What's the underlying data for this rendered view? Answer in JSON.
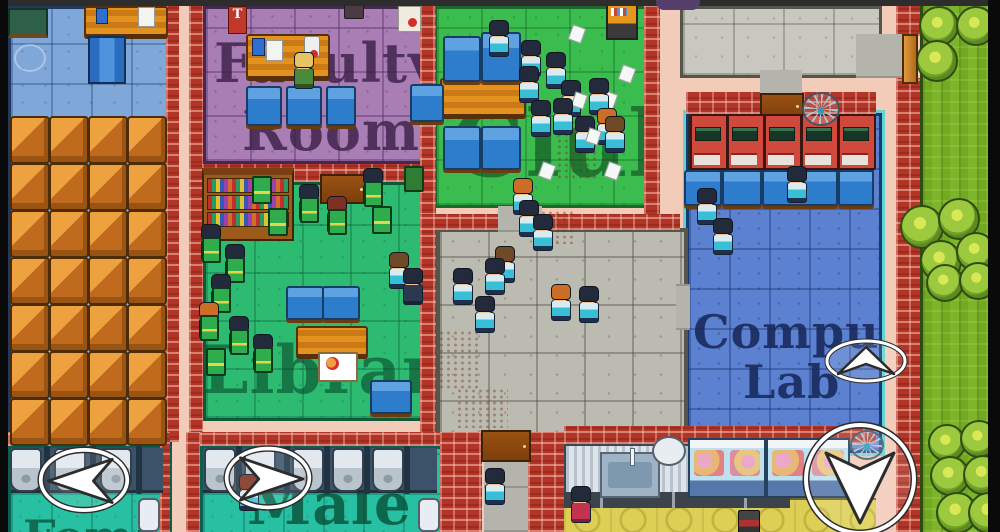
{
  "meta": {
    "width": 1000,
    "height": 532,
    "description": "Top-down pixel-art school simulation game scene"
  },
  "rooms": {
    "freshman": {
      "label": "Freshman"
    },
    "faculty": {
      "line1": "Faculty",
      "line2": "Room",
      "banner": "T"
    },
    "club": {
      "label": "Club"
    },
    "library": {
      "label": "Library"
    },
    "computer_lab": {
      "line1": "Computer",
      "line2": "Lab"
    },
    "male_toilet": {
      "label": "Male"
    },
    "female_toilet": {
      "label": "Female"
    }
  },
  "icons": {
    "nav_left": "arrow-left",
    "nav_right": "arrow-right",
    "nav_up": "arrow-up",
    "nav_down": "arrow-down",
    "web": "spider-web",
    "apple_sign": "apple"
  },
  "colors": {
    "corridor": "#f3cbb9",
    "brick": "#b23527",
    "classroom_floor": "#7fa8d9",
    "faculty_floor": "#a87eb4",
    "library_floor": "#2dbb72",
    "club_floor": "#3bbc4e",
    "lab_floor": "#5b81d0",
    "courtyard_floor": "#bcbbb2",
    "bathroom_floor": "#28c0a2",
    "kitchen_floor": "#ddcf55",
    "grass": "#74ac22",
    "hair": {
      "navy": "#222a3c",
      "orange": "#cc6d28",
      "brown": "#6e4a26",
      "blond": "#e5c564",
      "red": "#7e3122"
    },
    "outfit": {
      "student": "linear-gradient(#d7ebf3 0 35%,#38bfd6 35% 80%,#1d3050 80% 100%)",
      "teacher": "linear-gradient(#4a8a38 0 80%,#2c5420 80% 100%)",
      "suit": "linear-gradient(#2c3850 0 85%,#1a2335 85% 100%)",
      "cook": "linear-gradient(#c23350 0 85%,#7e1f33 85% 100%)"
    }
  },
  "scene": {
    "classroom_desks": {
      "cols": [
        10,
        49,
        88,
        127
      ],
      "rows": [
        116,
        163,
        210,
        257,
        304,
        351,
        398
      ]
    },
    "blue_desks": [
      {
        "x": 443,
        "y": 36,
        "w": 34,
        "h": 42
      },
      {
        "x": 481,
        "y": 32,
        "w": 36,
        "h": 46
      },
      {
        "x": 443,
        "y": 126,
        "w": 34,
        "h": 40
      },
      {
        "x": 481,
        "y": 126,
        "w": 36,
        "h": 40
      },
      {
        "x": 246,
        "y": 86,
        "w": 32,
        "h": 36
      },
      {
        "x": 286,
        "y": 86,
        "w": 32,
        "h": 36
      },
      {
        "x": 326,
        "y": 86,
        "w": 26,
        "h": 36
      },
      {
        "x": 410,
        "y": 84,
        "w": 30,
        "h": 34
      },
      {
        "x": 286,
        "y": 286,
        "w": 34,
        "h": 30
      },
      {
        "x": 322,
        "y": 286,
        "w": 34,
        "h": 30
      },
      {
        "x": 370,
        "y": 380,
        "w": 38,
        "h": 30
      },
      {
        "x": 684,
        "y": 170,
        "w": 34,
        "h": 32
      },
      {
        "x": 722,
        "y": 170,
        "w": 36,
        "h": 32
      },
      {
        "x": 762,
        "y": 170,
        "w": 72,
        "h": 32
      },
      {
        "x": 838,
        "y": 170,
        "w": 32,
        "h": 32
      }
    ],
    "computers": {
      "xs": [
        690,
        727,
        764,
        801,
        838
      ],
      "y": 114
    },
    "urinals": {
      "left": {
        "y": 448,
        "xs": [
          10,
          54,
          100
        ],
        "dividers": [
          44,
          90,
          136
        ]
      },
      "male": {
        "y": 448,
        "xs": [
          204,
          244,
          292,
          332,
          372
        ],
        "dividers": [
          236,
          284,
          324,
          364,
          404
        ]
      }
    },
    "persons": [
      {
        "x": 293,
        "y": 52,
        "hair": "blond",
        "outfit": "teacher"
      },
      {
        "x": 488,
        "y": 20,
        "hair": "navy"
      },
      {
        "x": 520,
        "y": 40,
        "hair": "navy"
      },
      {
        "x": 545,
        "y": 52,
        "hair": "navy"
      },
      {
        "x": 518,
        "y": 66,
        "hair": "navy"
      },
      {
        "x": 560,
        "y": 80,
        "hair": "navy",
        "paper": true
      },
      {
        "x": 588,
        "y": 78,
        "hair": "navy"
      },
      {
        "x": 552,
        "y": 98,
        "hair": "navy"
      },
      {
        "x": 530,
        "y": 100,
        "hair": "navy"
      },
      {
        "x": 596,
        "y": 108,
        "hair": "orange"
      },
      {
        "x": 574,
        "y": 116,
        "hair": "navy",
        "paper": true
      },
      {
        "x": 604,
        "y": 116,
        "hair": "brown"
      },
      {
        "x": 512,
        "y": 178,
        "hair": "orange"
      },
      {
        "x": 518,
        "y": 200,
        "hair": "navy"
      },
      {
        "x": 532,
        "y": 214,
        "hair": "navy"
      },
      {
        "x": 494,
        "y": 246,
        "hair": "brown"
      },
      {
        "x": 452,
        "y": 268,
        "hair": "navy"
      },
      {
        "x": 484,
        "y": 258,
        "hair": "navy"
      },
      {
        "x": 474,
        "y": 296,
        "hair": "navy"
      },
      {
        "x": 550,
        "y": 284,
        "hair": "orange"
      },
      {
        "x": 578,
        "y": 286,
        "hair": "navy"
      },
      {
        "x": 484,
        "y": 468,
        "hair": "navy"
      },
      {
        "x": 238,
        "y": 474,
        "hair": "red"
      },
      {
        "x": 696,
        "y": 188,
        "hair": "navy"
      },
      {
        "x": 712,
        "y": 218,
        "hair": "navy"
      },
      {
        "x": 786,
        "y": 166,
        "hair": "navy"
      },
      {
        "x": 298,
        "y": 184,
        "hair": "navy",
        "book": true
      },
      {
        "x": 326,
        "y": 196,
        "hair": "red",
        "book": true
      },
      {
        "x": 362,
        "y": 168,
        "hair": "navy",
        "book": true
      },
      {
        "x": 200,
        "y": 224,
        "hair": "navy",
        "book": true
      },
      {
        "x": 224,
        "y": 244,
        "hair": "navy",
        "book": true
      },
      {
        "x": 210,
        "y": 274,
        "hair": "navy",
        "book": true
      },
      {
        "x": 198,
        "y": 302,
        "hair": "orange",
        "book": true
      },
      {
        "x": 228,
        "y": 316,
        "hair": "navy",
        "book": true
      },
      {
        "x": 252,
        "y": 334,
        "hair": "navy",
        "book": true
      },
      {
        "x": 388,
        "y": 252,
        "hair": "brown"
      },
      {
        "x": 402,
        "y": 268,
        "hair": "navy",
        "outfit": "suit"
      },
      {
        "x": 570,
        "y": 486,
        "hair": "navy",
        "outfit": "cook"
      }
    ],
    "loose_books": [
      {
        "x": 252,
        "y": 176
      },
      {
        "x": 268,
        "y": 208
      },
      {
        "x": 206,
        "y": 348
      },
      {
        "x": 372,
        "y": 206
      }
    ],
    "papers": [
      {
        "x": 570,
        "y": 26
      },
      {
        "x": 620,
        "y": 66
      },
      {
        "x": 602,
        "y": 92
      },
      {
        "x": 540,
        "y": 163
      },
      {
        "x": 606,
        "y": 163
      }
    ],
    "bushes": [
      {
        "x": 919,
        "y": 6,
        "s": 36
      },
      {
        "x": 956,
        "y": 6,
        "s": 36
      },
      {
        "x": 916,
        "y": 40,
        "s": 38
      },
      {
        "x": 900,
        "y": 205,
        "s": 40
      },
      {
        "x": 938,
        "y": 198,
        "s": 38
      },
      {
        "x": 920,
        "y": 240,
        "s": 38
      },
      {
        "x": 956,
        "y": 232,
        "s": 36
      },
      {
        "x": 926,
        "y": 264,
        "s": 34
      },
      {
        "x": 959,
        "y": 262,
        "s": 34
      },
      {
        "x": 928,
        "y": 424,
        "s": 34
      },
      {
        "x": 960,
        "y": 420,
        "s": 34
      },
      {
        "x": 930,
        "y": 456,
        "s": 36
      },
      {
        "x": 963,
        "y": 455,
        "s": 36
      },
      {
        "x": 936,
        "y": 492,
        "s": 38
      },
      {
        "x": 968,
        "y": 492,
        "s": 38
      }
    ]
  }
}
